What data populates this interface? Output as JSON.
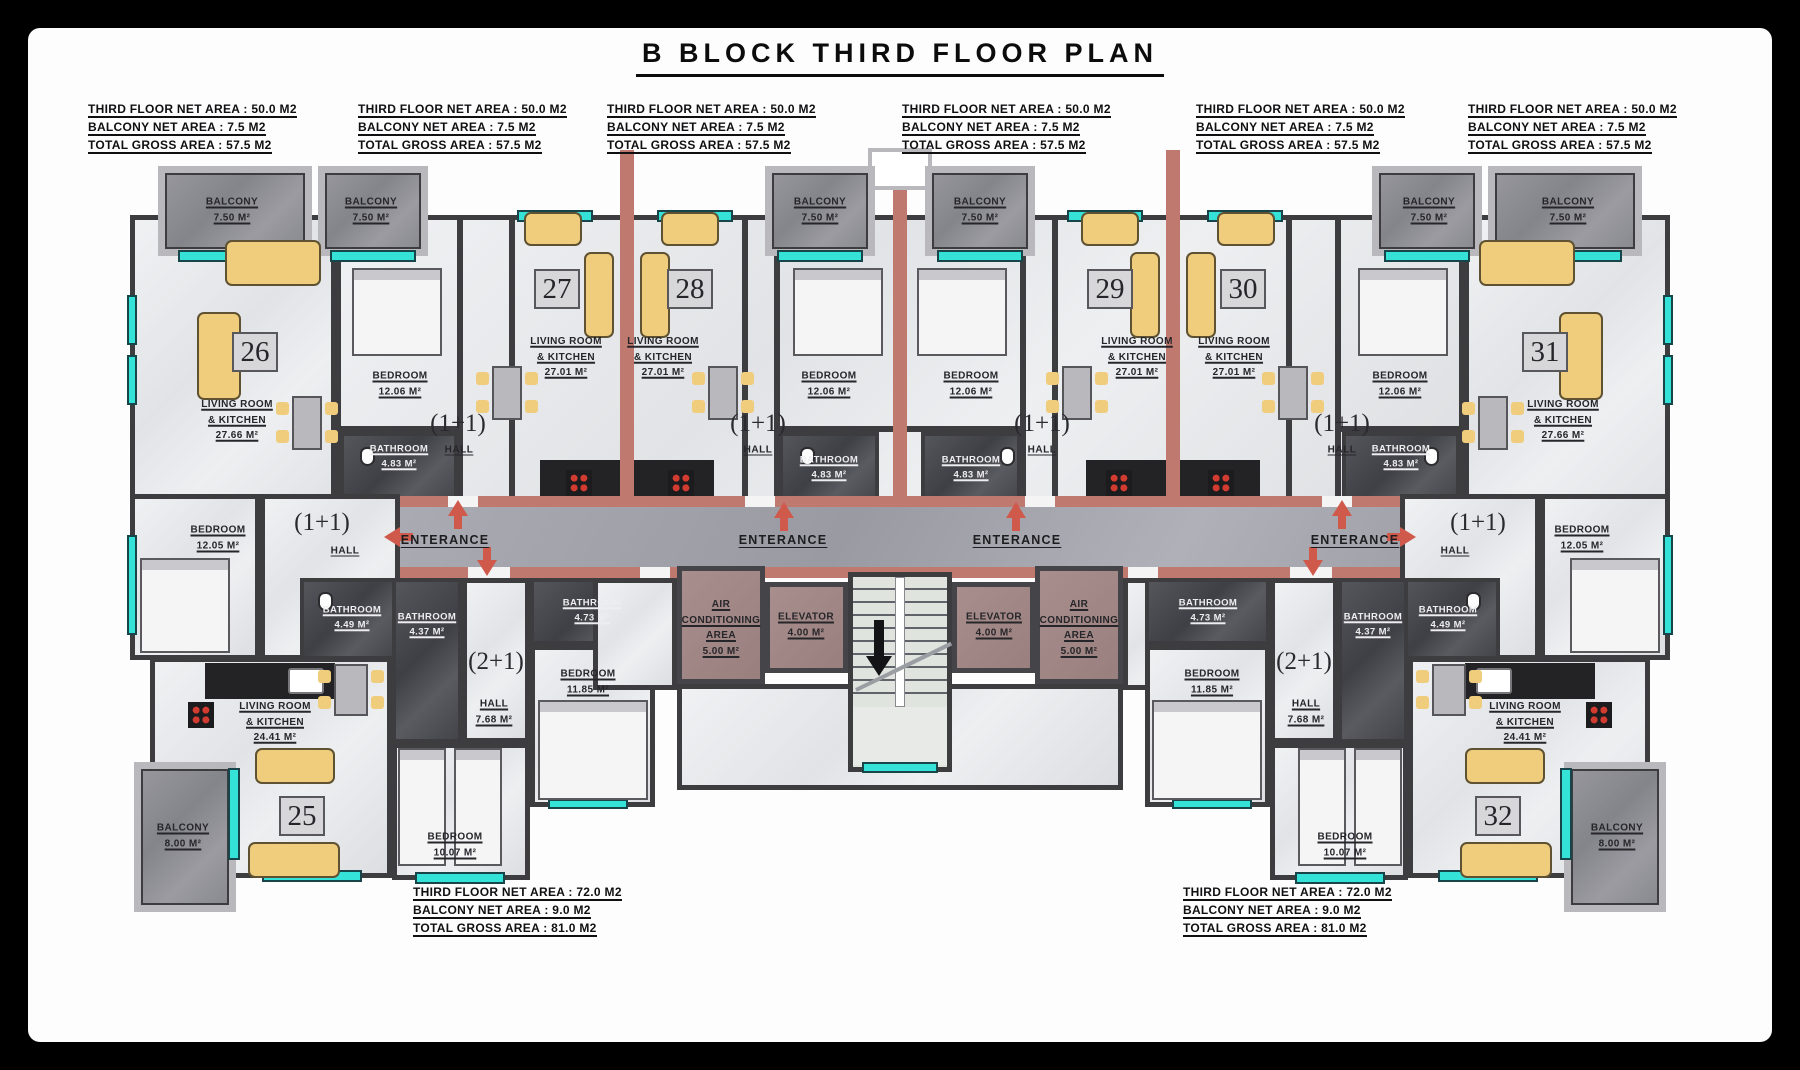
{
  "title": "B BLOCK THIRD FLOOR PLAN",
  "info": {
    "top": [
      {
        "l1": "THIRD FLOOR NET AREA : 50.0 M2",
        "l2": "BALCONY NET AREA : 7.5 M2",
        "l3": "TOTAL GROSS AREA : 57.5 M2"
      },
      {
        "l1": "THIRD FLOOR NET AREA : 50.0 M2",
        "l2": "BALCONY NET AREA : 7.5 M2",
        "l3": "TOTAL GROSS AREA : 57.5 M2"
      },
      {
        "l1": "THIRD FLOOR NET AREA : 50.0 M2",
        "l2": "BALCONY NET AREA : 7.5 M2",
        "l3": "TOTAL GROSS AREA : 57.5 M2"
      },
      {
        "l1": "THIRD FLOOR NET AREA : 50.0 M2",
        "l2": "BALCONY NET AREA : 7.5 M2",
        "l3": "TOTAL GROSS AREA : 57.5 M2"
      },
      {
        "l1": "THIRD FLOOR NET AREA : 50.0 M2",
        "l2": "BALCONY NET AREA : 7.5 M2",
        "l3": "TOTAL GROSS AREA : 57.5 M2"
      },
      {
        "l1": "THIRD FLOOR NET AREA : 50.0 M2",
        "l2": "BALCONY NET AREA : 7.5 M2",
        "l3": "TOTAL GROSS AREA : 57.5 M2"
      }
    ],
    "bottom": [
      {
        "l1": "THIRD FLOOR NET AREA : 72.0 M2",
        "l2": "BALCONY NET AREA : 9.0 M2",
        "l3": "TOTAL GROSS AREA : 81.0 M2"
      },
      {
        "l1": "THIRD FLOOR NET AREA : 72.0 M2",
        "l2": "BALCONY NET AREA : 9.0 M2",
        "l3": "TOTAL GROSS AREA : 81.0 M2"
      }
    ]
  },
  "units": {
    "n25": "25",
    "n26": "26",
    "n27": "27",
    "n28": "28",
    "n29": "29",
    "n30": "30",
    "n31": "31",
    "n32": "32"
  },
  "rooms": {
    "balcony75": {
      "t": "BALCONY",
      "a": "7.50 M²"
    },
    "balcony80": {
      "t": "BALCONY",
      "a": "8.00 M²"
    },
    "lrk2766": {
      "t1": "LIVING ROOM",
      "t2": "& KITCHEN",
      "a": "27.66 M²"
    },
    "lrk2701": {
      "t1": "LIVING ROOM",
      "t2": "& KITCHEN",
      "a": "27.01 M²"
    },
    "lrk2441": {
      "t1": "LIVING ROOM",
      "t2": "& KITCHEN",
      "a": "24.41 M²"
    },
    "bed1206": {
      "t": "BEDROOM",
      "a": "12.06 M²"
    },
    "bed1205": {
      "t": "BEDROOM",
      "a": "12.05 M²"
    },
    "bed1185": {
      "t": "BEDROOM",
      "a": "11.85 M²"
    },
    "bed1007": {
      "t": "BEDROOM",
      "a": "10.07 M²"
    },
    "bath483": {
      "t": "BATHROOM",
      "a": "4.83 M²"
    },
    "bath449": {
      "t": "BATHROOM",
      "a": "4.49 M²"
    },
    "bath437": {
      "t": "BATHROOM",
      "a": "4.37 M²"
    },
    "bath473": {
      "t": "BATHROOM",
      "a": "4.73 M²"
    },
    "hall": "HALL",
    "hall768": {
      "t": "HALL",
      "a": "7.68 M²"
    },
    "type11": "(1+1)",
    "type21": "(2+1)",
    "enterance": "ENTERANCE",
    "elevator": {
      "t": "ELEVATOR",
      "a": "4.00 M²"
    },
    "ac": {
      "t1": "AIR",
      "t2": "CONDITIONING",
      "t3": "AREA",
      "a": "5.00 M²"
    }
  },
  "colors": {
    "wall": "#3d3d40",
    "party_wall": "#c0796f",
    "window": "#35e2d8",
    "bathroom": "#4e4e54",
    "corridor": "#a6a6ae",
    "service": "#a28888",
    "furniture": "#f0cc7d",
    "arrow": "#cf5a4c"
  }
}
